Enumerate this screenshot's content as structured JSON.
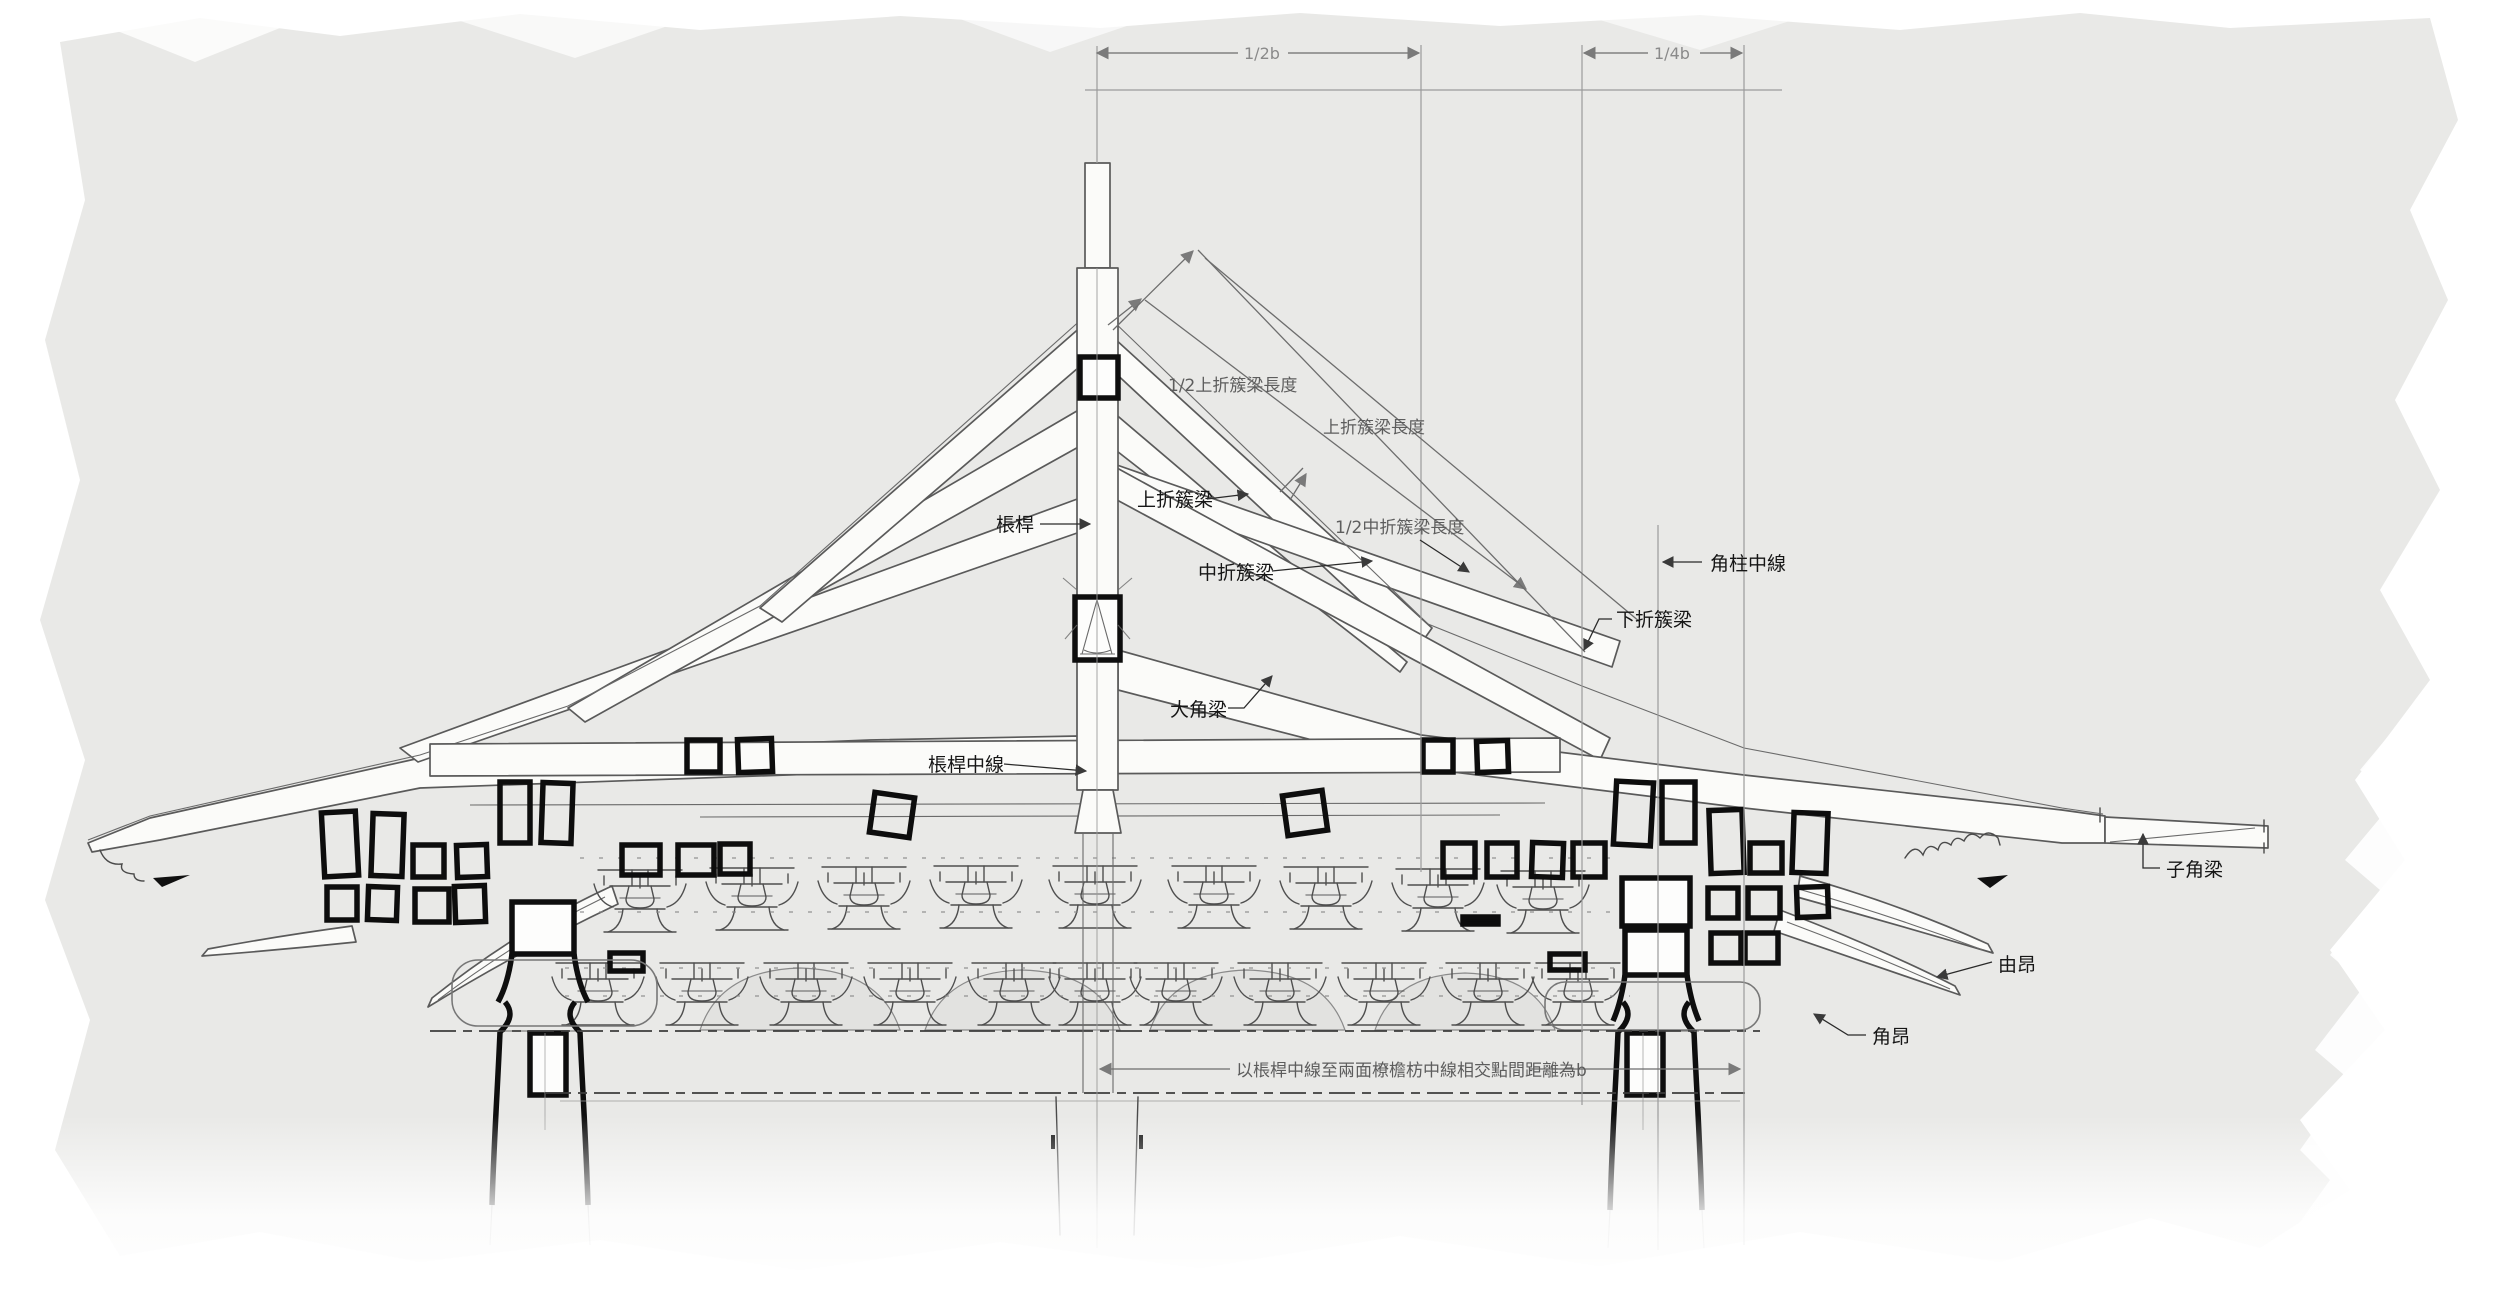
{
  "drawing": {
    "kind": "hand-drawn architectural section sketch, traditional Chinese timber roof corner framing",
    "paper_color": "#e9e9e7",
    "ink_color": "#4a4a4a",
    "heavy_ink_color": "#0e0e0e",
    "label_ink_color": "#161616",
    "dim_ink_color": "#5d5d5d"
  },
  "labels": {
    "half_b": "1/2b",
    "quarter_b": "1/4b",
    "half_upper_fold_len": "1/2上折簇梁長度",
    "upper_fold_len": "上折簇梁長度",
    "upper_fold": "上折簇梁",
    "ridge_post": "棖桿",
    "mid_fold": "中折簇梁",
    "half_mid_fold_len": "1/2中折簇梁長度",
    "lower_fold": "下折簇梁",
    "corner_column_centerline": "角柱中線",
    "great_corner_beam": "大角梁",
    "ridge_post_centerline": "棖桿中線",
    "sub_corner_beam": "子角梁",
    "you_ang": "由昂",
    "jiao_ang": "角昂",
    "bottom_note": "以棖桿中線至兩面橑檐枋中線相交點間距離為b"
  }
}
